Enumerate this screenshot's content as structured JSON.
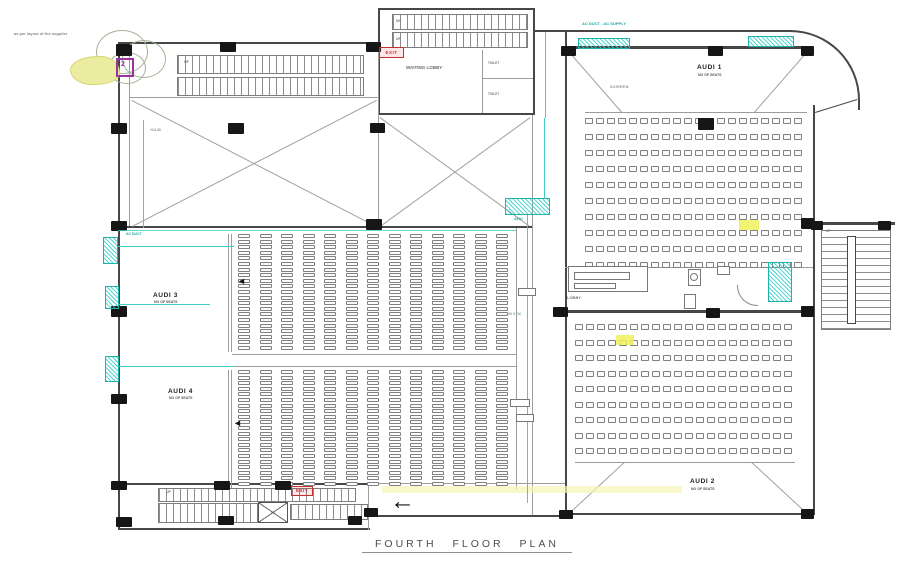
{
  "title": "FOURTH FLOOR PLAN",
  "site_note": "as per layout of the supplier",
  "auditoriums": {
    "audi1": {
      "label": "AUDI 1",
      "sublabel": "NO OF SEATS"
    },
    "audi2": {
      "label": "AUDI 2",
      "sublabel": "NO OF SEATS"
    },
    "audi3": {
      "label": "AUDI 3",
      "sublabel": "NO OF SEATS"
    },
    "audi4": {
      "label": "AUDI 4",
      "sublabel": "NO OF SEATS"
    }
  },
  "seating": {
    "audi1": {
      "rows": 10,
      "cols": 20
    },
    "audi2": {
      "rows": 9,
      "cols": 20
    },
    "audi3": {
      "rows": 21,
      "cols": 13
    },
    "audi4": {
      "rows": 21,
      "cols": 13
    }
  },
  "rooms": {
    "waiting_lobby": "WAITING LOBBY",
    "toilet_1": "TOILET",
    "toilet_2": "TOILET",
    "lobby": "LOBBY",
    "screen": "SCREEN",
    "level_mark": "+14.40"
  },
  "stairs": {
    "up_1": "UP",
    "dn_1": "DN",
    "up_2": "UP",
    "up_3": "UP",
    "up_4": "UP"
  },
  "hvac": {
    "supply_note": "AC DUCT - AC SUPPLY",
    "grill_note": "AC DUCT",
    "ahu_label": "AHU",
    "duct_size": "20 X OC"
  },
  "exits": {
    "exit_1": "EXIT",
    "exit_2": "EXIT"
  },
  "icons": {
    "entry_arrow": "←",
    "row_arrow": "◄"
  },
  "detail_marker": "2",
  "colors": {
    "cyan": "#3ecfc8",
    "red": "#c53030",
    "purple": "#9a35a0",
    "yellow": "#f2f2b0"
  }
}
